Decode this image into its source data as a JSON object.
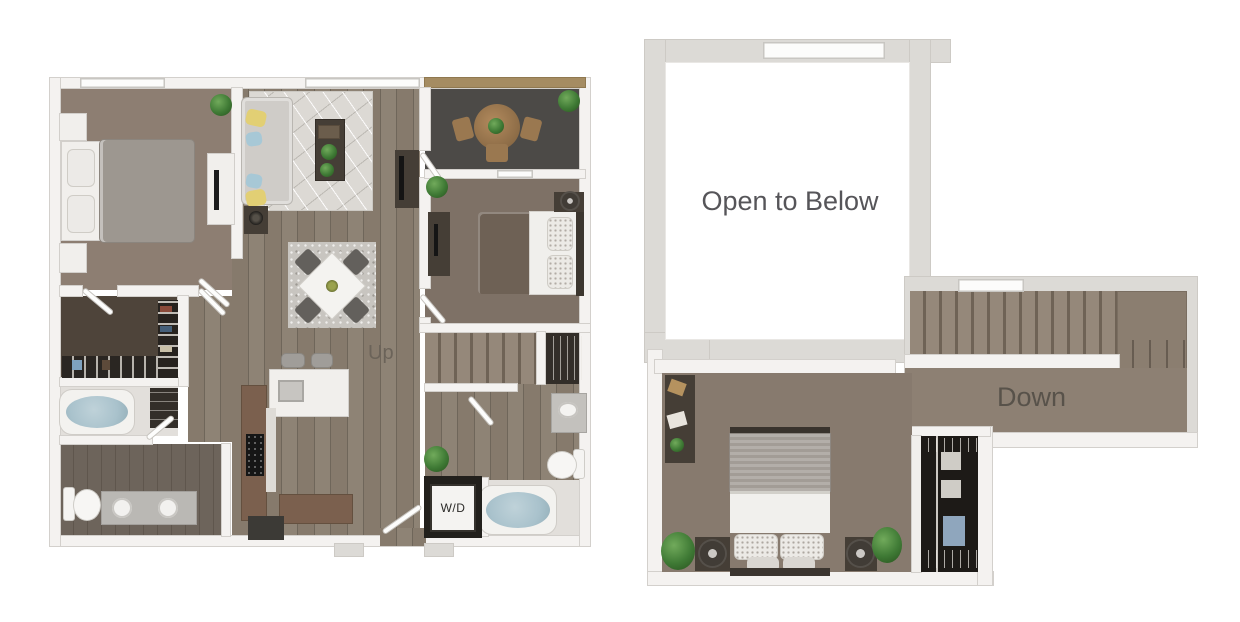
{
  "palette": {
    "wall": "#f4f2f0",
    "wall_edge": "#d3d0cc",
    "wall_gray": "#dcdad6",
    "wood_floor": "#867a6c",
    "wood_floor_line": "#6f665a",
    "carpet": "#8d7e72",
    "carpet_dark": "#7e7166",
    "balcony_floor": "#4c4a47",
    "closet_floor": "#4e443a",
    "tile_light": "#e2dfdb",
    "bath_floor": "#6d645b",
    "stair_tread": "#95887a",
    "stair_gap": "#6f6356",
    "rug_color": "#dcd9d4",
    "dining_rug": "#c8c5c0",
    "sofa_color": "#cfccc8",
    "pillow_yellow": "#e2cf74",
    "pillow_blue": "#a7c8d6",
    "bed_gray": "#9d9790",
    "bed_brown": "#6e6155",
    "dark_wood": "#453e36",
    "counter_brown": "#7b604e",
    "water_blue": "#a9c2cc",
    "plant_green": "#3f7a35",
    "label_text": "#5c5955"
  },
  "first_floor": {
    "labels": {
      "up": "Up",
      "washer_dryer": "W/D"
    }
  },
  "second_floor": {
    "labels": {
      "open_to_below": "Open to Below",
      "down": "Down"
    }
  }
}
